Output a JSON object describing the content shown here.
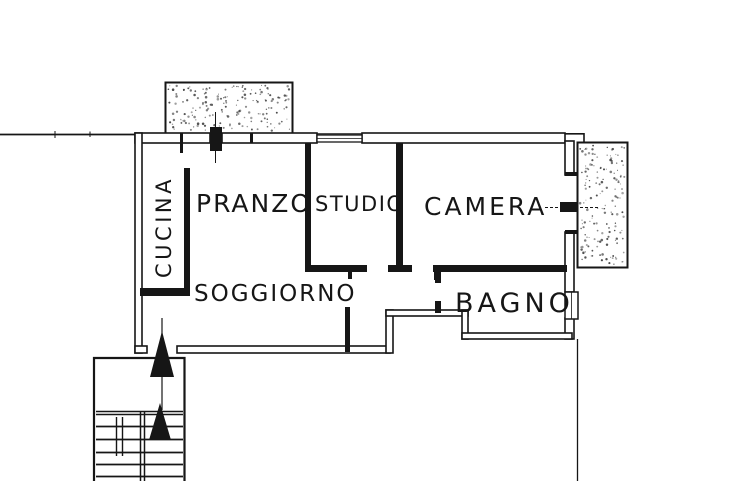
{
  "plan": {
    "kind": "apartment floor plan (scanned line drawing)",
    "rooms": [
      {
        "id": "cucina",
        "label": "CUCINA",
        "orientation": "vertical"
      },
      {
        "id": "pranzo",
        "label": "PRANZO",
        "orientation": "horizontal"
      },
      {
        "id": "studio",
        "label": "STUDIO",
        "orientation": "horizontal"
      },
      {
        "id": "camera",
        "label": "CAMERA",
        "orientation": "horizontal"
      },
      {
        "id": "soggiorno",
        "label": "SOGGIORNO",
        "orientation": "horizontal"
      },
      {
        "id": "bagno",
        "label": "BAGNO",
        "orientation": "horizontal"
      }
    ],
    "features": {
      "balconies": 2,
      "stair_flights": 1,
      "direction_arrows": 2
    },
    "icons": [
      {
        "name": "direction-arrow-up",
        "glyph": "▲"
      }
    ],
    "colors": {
      "line": "#161616",
      "background": "#ffffff",
      "speckle": "#3c3c3c"
    }
  }
}
